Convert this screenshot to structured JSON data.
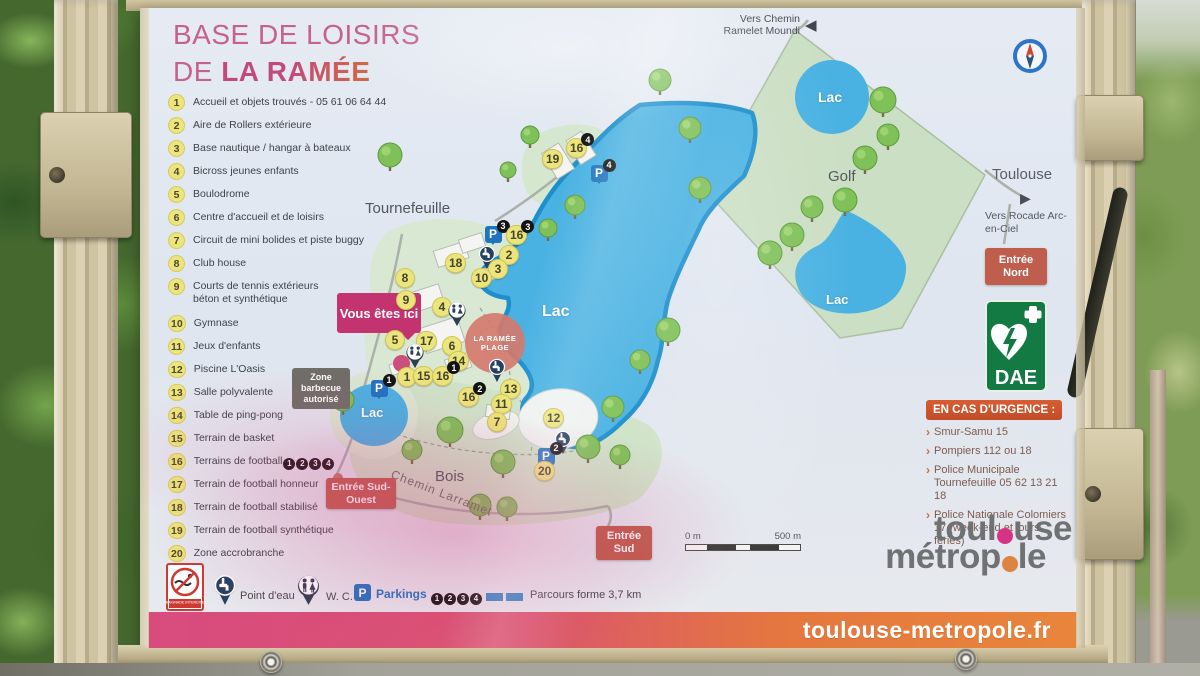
{
  "title": {
    "line1": "BASE DE LOISIRS",
    "line2_prefix": "DE ",
    "line2_name": "LA RAMÉE"
  },
  "legend": [
    {
      "n": "1",
      "label": "Accueil et objets trouvés - 05 61 06 64 44"
    },
    {
      "n": "2",
      "label": "Aire de Rollers extérieure"
    },
    {
      "n": "3",
      "label": "Base nautique / hangar à bateaux"
    },
    {
      "n": "4",
      "label": "Bicross jeunes enfants"
    },
    {
      "n": "5",
      "label": "Boulodrome"
    },
    {
      "n": "6",
      "label": "Centre d'accueil et de loisirs"
    },
    {
      "n": "7",
      "label": "Circuit de mini bolides et piste buggy"
    },
    {
      "n": "8",
      "label": "Club house"
    },
    {
      "n": "9",
      "label": "Courts de tennis extérieurs\nbéton et synthétique"
    },
    {
      "n": "10",
      "label": "Gymnase"
    },
    {
      "n": "11",
      "label": "Jeux d'enfants"
    },
    {
      "n": "12",
      "label": "Piscine L'Oasis"
    },
    {
      "n": "13",
      "label": "Salle polyvalente"
    },
    {
      "n": "14",
      "label": "Table de ping-pong"
    },
    {
      "n": "15",
      "label": "Terrain de basket"
    },
    {
      "n": "16",
      "label": "Terrains de football",
      "badges": [
        "1",
        "2",
        "3",
        "4"
      ]
    },
    {
      "n": "17",
      "label": "Terrain de football honneur"
    },
    {
      "n": "18",
      "label": "Terrain de football stabilisé"
    },
    {
      "n": "19",
      "label": "Terrain de football synthétique"
    },
    {
      "n": "20",
      "label": "Zone accrobranche"
    }
  ],
  "map": {
    "labels": {
      "town": "Tournefeuille",
      "golf": "Golf",
      "lake_main": "Lac",
      "lake_golf_top": "Lac",
      "lake_golf_bottom": "Lac",
      "lake_small": "Lac",
      "woods": "Bois",
      "road": "Chemin Larramet",
      "toulouse": "Toulouse",
      "to_rocade": "Vers Rocade Arc-en-Ciel",
      "to_chemin": "Vers Chemin Ramelet Moundi"
    },
    "badges": {
      "you_are_here": "Vous êtes ici",
      "barbecue": "Zone barbecue autorisé",
      "north": "Entrée Nord",
      "south": "Entrée Sud",
      "southwest": "Entrée Sud-Ouest"
    },
    "plage_logo": "LA RAMÉE PLAGE",
    "scale": {
      "left": "0 m",
      "right": "500 m"
    },
    "markers": [
      {
        "t": "num",
        "n": "19",
        "x": 414,
        "y": 151
      },
      {
        "t": "num",
        "n": "16",
        "x": 438,
        "y": 140,
        "b": "4"
      },
      {
        "t": "p",
        "x": 459,
        "y": 165,
        "b": "4"
      },
      {
        "t": "p",
        "x": 353,
        "y": 226,
        "b": "3"
      },
      {
        "t": "num",
        "n": "16",
        "x": 378,
        "y": 227,
        "b": "3"
      },
      {
        "t": "tap",
        "x": 347,
        "y": 249
      },
      {
        "t": "num",
        "n": "18",
        "x": 317,
        "y": 255
      },
      {
        "t": "num",
        "n": "2",
        "x": 369,
        "y": 247
      },
      {
        "t": "num",
        "n": "3",
        "x": 358,
        "y": 261
      },
      {
        "t": "num",
        "n": "10",
        "x": 343,
        "y": 270
      },
      {
        "t": "num",
        "n": "8",
        "x": 265,
        "y": 270
      },
      {
        "t": "num",
        "n": "9",
        "x": 266,
        "y": 292
      },
      {
        "t": "num",
        "n": "4",
        "x": 302,
        "y": 299
      },
      {
        "t": "wc",
        "x": 317,
        "y": 305
      },
      {
        "t": "num",
        "n": "5",
        "x": 255,
        "y": 332
      },
      {
        "t": "num",
        "n": "17",
        "x": 288,
        "y": 333
      },
      {
        "t": "num",
        "n": "6",
        "x": 312,
        "y": 338
      },
      {
        "t": "num",
        "n": "14",
        "x": 320,
        "y": 353
      },
      {
        "t": "wc",
        "x": 275,
        "y": 347
      },
      {
        "t": "dot",
        "x": 261,
        "y": 355
      },
      {
        "t": "num",
        "n": "1",
        "x": 267,
        "y": 369
      },
      {
        "t": "num",
        "n": "15",
        "x": 285,
        "y": 368
      },
      {
        "t": "num",
        "n": "16",
        "x": 304,
        "y": 368,
        "b": "1"
      },
      {
        "t": "p",
        "x": 239,
        "y": 380,
        "b": "1"
      },
      {
        "t": "num",
        "n": "16",
        "x": 330,
        "y": 389,
        "b": "2"
      },
      {
        "t": "num",
        "n": "13",
        "x": 372,
        "y": 381
      },
      {
        "t": "num",
        "n": "11",
        "x": 363,
        "y": 396
      },
      {
        "t": "num",
        "n": "7",
        "x": 357,
        "y": 414
      },
      {
        "t": "tap",
        "x": 357,
        "y": 362
      },
      {
        "t": "num",
        "n": "12",
        "x": 415,
        "y": 410
      },
      {
        "t": "tap",
        "x": 423,
        "y": 434
      },
      {
        "t": "p",
        "x": 406,
        "y": 448,
        "b": "2"
      },
      {
        "t": "num",
        "n": "20",
        "x": 406,
        "y": 463
      }
    ]
  },
  "emergency": {
    "header": "EN CAS D'URGENCE :",
    "lines": [
      "Smur-Samu  15",
      "Pompiers  112 ou 18",
      "Police Municipale Tournefeuille  05 62 13 21 18",
      "Police Nationale Colomiers 17 (week-end et jours fériés)"
    ]
  },
  "dae_label": "DAE",
  "footer": {
    "no_swim": "BAIGNADE INTERDITE",
    "water": "Point d'eau",
    "wc": "W. C.",
    "parkings": "Parkings",
    "parking_badges": [
      "1",
      "2",
      "3",
      "4"
    ],
    "trail": "Parcours forme 3,7 km"
  },
  "brand": {
    "l1a": "toul",
    "l1b": "use",
    "l2a": "métrop",
    "l2b": "le",
    "url": "toulouse-metropole.fr"
  }
}
